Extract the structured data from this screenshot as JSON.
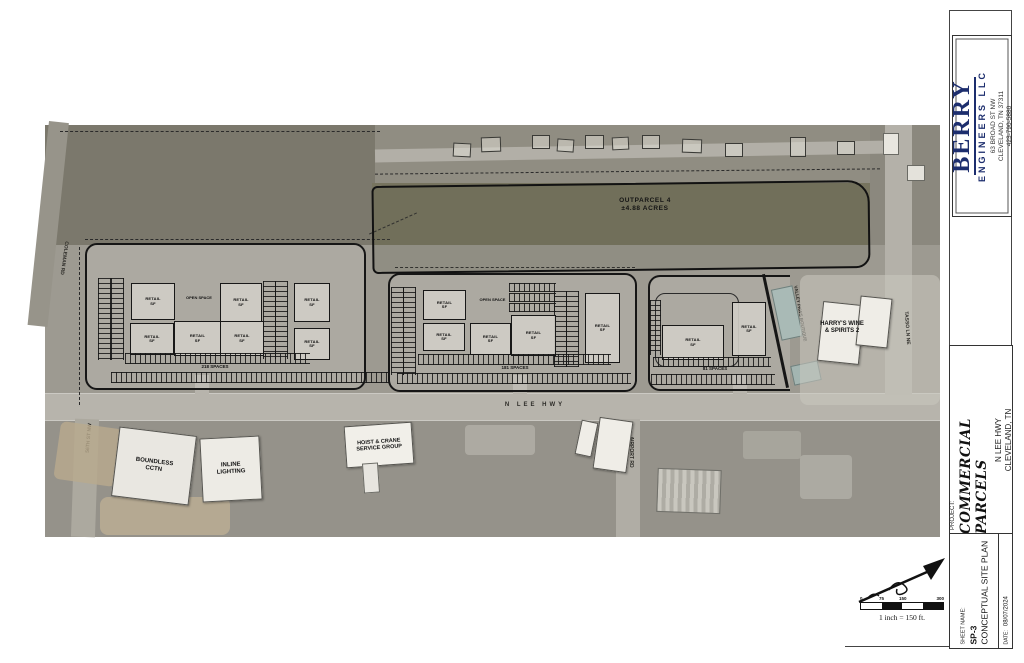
{
  "title_block": {
    "firm": {
      "name": "BERRY",
      "tagline": "ENGINEERS LLC",
      "address_line1": "63 BROAD ST NW",
      "address_line2": "CLEVELAND, TN 37311",
      "address_line3": "423-790-5880",
      "brand_color": "#1d2e6e"
    },
    "project": {
      "label": "PROJECT:",
      "title": "COMMERCIAL PARCELS",
      "location_line1": "N LEE HWY",
      "location_line2": "CLEVELAND, TN"
    },
    "sheet_block": {
      "label": "SHEET NAME:",
      "number": "SP-3",
      "name": "CONCEPTUAL SITE PLAN",
      "date_label": "DATE:",
      "date_value": "08/07/2024"
    }
  },
  "plan": {
    "outparcel_line1": "OUTPARCEL 4",
    "outparcel_line2": "±4.88 ACRES",
    "open_space": "OPEN SPACE",
    "retail_line1": "RETAIL",
    "retail_line2": "SF",
    "left_parcel_spaces": "218 SPACES",
    "middle_parcel_spaces": "181 SPACES",
    "right_parcel_spaces": "81 SPACES",
    "streets": {
      "n_lee_hwy": "N LEE HWY",
      "airport_rd": "AIRPORT RD",
      "tasso_ln_ne": "TASSO LN NE",
      "coleman_rd": "COLEMAN RD",
      "fifty_sixth_st_nw": "56TH ST NW"
    },
    "businesses": {
      "harrys_line1": "HARRY'S WINE",
      "harrys_line2": "& SPIRITS 2",
      "valley_paws": "VALLEY PAWS BOUTIQUE",
      "boundless_line1": "BOUNDLESS",
      "boundless_line2": "CCTN",
      "inline_line1": "INLINE",
      "inline_line2": "LIGHTING",
      "hoist_line1": "HOIST & CRANE",
      "hoist_line2": "SERVICE GROUP"
    }
  },
  "scale_bar": {
    "ticks": [
      "0",
      "75",
      "150",
      "300"
    ],
    "caption": "1 inch = 150 ft."
  }
}
